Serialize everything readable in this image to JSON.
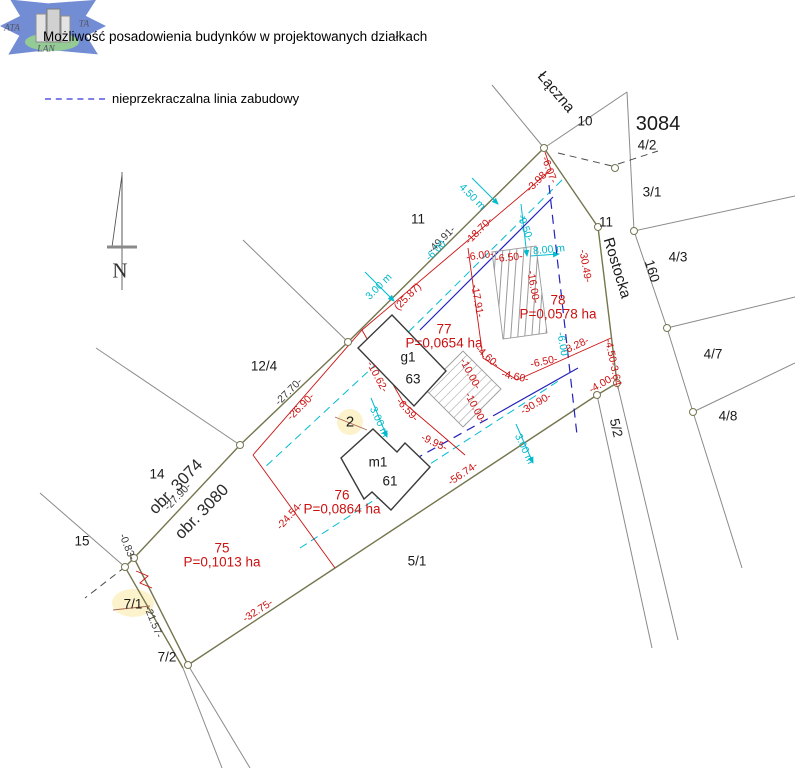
{
  "title": "Możliwość posadowienia budynków w projektowanych działkach",
  "legend": {
    "label": "nieprzekraczalna linia zabudowy",
    "line_color": "#8080e8"
  },
  "logo": {
    "texts": [
      "ATA",
      "TA",
      "LAN"
    ]
  },
  "colors": {
    "boundary_olive": "#75754e",
    "neighbor_gray": "#8a8a8a",
    "design_red": "#cc1111",
    "offset_cyan": "#00bcd0",
    "building_line_navy": "#2323bb",
    "highlight_yellow": "#fcf3cc"
  },
  "map_labels": [
    {
      "t": "Łączna",
      "x": 556,
      "y": 92,
      "r": 50,
      "k": "street"
    },
    {
      "t": "Rostocka",
      "x": 617,
      "y": 268,
      "r": 73,
      "k": "street"
    },
    {
      "t": "10",
      "x": 585,
      "y": 121,
      "r": 0,
      "k": "parcel"
    },
    {
      "t": "3084",
      "x": 658,
      "y": 124,
      "r": 0,
      "k": "parcel",
      "fs": 20
    },
    {
      "t": "4/2",
      "x": 647,
      "y": 145,
      "r": 0,
      "k": "parcel"
    },
    {
      "t": "3/1",
      "x": 652,
      "y": 192,
      "r": 0,
      "k": "parcel"
    },
    {
      "t": "11",
      "x": 606,
      "y": 222,
      "r": 0,
      "k": "parcel"
    },
    {
      "t": "160",
      "x": 652,
      "y": 271,
      "r": 73,
      "k": "parcel"
    },
    {
      "t": "4/3",
      "x": 678,
      "y": 257,
      "r": 0,
      "k": "parcel"
    },
    {
      "t": "4/7",
      "x": 713,
      "y": 354,
      "r": 0,
      "k": "parcel"
    },
    {
      "t": "4/8",
      "x": 728,
      "y": 416,
      "r": 0,
      "k": "parcel"
    },
    {
      "t": "5/2",
      "x": 616,
      "y": 428,
      "r": 77,
      "k": "parcel"
    },
    {
      "t": "5/1",
      "x": 417,
      "y": 561,
      "r": 0,
      "k": "parcel"
    },
    {
      "t": "11",
      "x": 418,
      "y": 219,
      "r": 0,
      "k": "parcel"
    },
    {
      "t": "12/4",
      "x": 264,
      "y": 366,
      "r": 0,
      "k": "parcel"
    },
    {
      "t": "14",
      "x": 157,
      "y": 474,
      "r": 0,
      "k": "parcel"
    },
    {
      "t": "15",
      "x": 82,
      "y": 541,
      "r": 0,
      "k": "parcel"
    },
    {
      "t": "7/1",
      "x": 133,
      "y": 604,
      "r": 0,
      "k": "parcel"
    },
    {
      "t": "7/2",
      "x": 167,
      "y": 657,
      "r": 0,
      "k": "parcel"
    },
    {
      "t": "2",
      "x": 350,
      "y": 422,
      "r": 0,
      "k": "parcel",
      "fs": 15
    },
    {
      "t": "g1",
      "x": 408,
      "y": 357,
      "r": 0,
      "k": "parcel"
    },
    {
      "t": "63",
      "x": 413,
      "y": 379,
      "r": 0,
      "k": "parcel"
    },
    {
      "t": "m1",
      "x": 378,
      "y": 462,
      "r": 0,
      "k": "parcel"
    },
    {
      "t": "61",
      "x": 390,
      "y": 481,
      "r": 0,
      "k": "parcel"
    },
    {
      "t": "obr. 3074",
      "x": 176,
      "y": 487,
      "r": -46,
      "k": "obr"
    },
    {
      "t": "obr. 3080",
      "x": 202,
      "y": 512,
      "r": -46,
      "k": "obr"
    },
    {
      "t": "N",
      "x": 120,
      "y": 271,
      "r": 0,
      "k": "north"
    },
    {
      "t": "75",
      "x": 222,
      "y": 548,
      "r": 0,
      "k": "redarea"
    },
    {
      "t": "P=0,1013 ha",
      "x": 222,
      "y": 562,
      "r": 0,
      "k": "redarea"
    },
    {
      "t": "76",
      "x": 342,
      "y": 495,
      "r": 0,
      "k": "redarea"
    },
    {
      "t": "P=0,0864 ha",
      "x": 342,
      "y": 509,
      "r": 0,
      "k": "redarea"
    },
    {
      "t": "77",
      "x": 444,
      "y": 329,
      "r": 0,
      "k": "redarea"
    },
    {
      "t": "P=0,0654 ha",
      "x": 444,
      "y": 343,
      "r": 0,
      "k": "redarea"
    },
    {
      "t": "78",
      "x": 558,
      "y": 300,
      "r": 0,
      "k": "redarea"
    },
    {
      "t": "P=0,0578 ha",
      "x": 558,
      "y": 314,
      "r": 0,
      "k": "redarea"
    },
    {
      "t": "-6.07-",
      "x": 549,
      "y": 170,
      "r": 70,
      "k": "red"
    },
    {
      "t": "-3.98-",
      "x": 538,
      "y": 181,
      "r": -45,
      "k": "red"
    },
    {
      "t": "-18.70-",
      "x": 479,
      "y": 231,
      "r": -45,
      "k": "red"
    },
    {
      "t": "(25.87)",
      "x": 408,
      "y": 297,
      "r": -45,
      "k": "red"
    },
    {
      "t": "-26.90-",
      "x": 301,
      "y": 407,
      "r": -45,
      "k": "red"
    },
    {
      "t": "-24.54-",
      "x": 290,
      "y": 516,
      "r": -48,
      "k": "red"
    },
    {
      "t": "-32.75-",
      "x": 258,
      "y": 611,
      "r": -33,
      "k": "red"
    },
    {
      "t": "-56.74-",
      "x": 463,
      "y": 474,
      "r": -34,
      "k": "red"
    },
    {
      "t": "-30.90-",
      "x": 536,
      "y": 404,
      "r": -30,
      "k": "red"
    },
    {
      "t": "-17.91-",
      "x": 477,
      "y": 301,
      "r": 80,
      "k": "red"
    },
    {
      "t": "-10.62-",
      "x": 377,
      "y": 377,
      "r": 62,
      "k": "red"
    },
    {
      "t": "-6.59-",
      "x": 407,
      "y": 410,
      "r": 48,
      "k": "red"
    },
    {
      "t": "-9.95-",
      "x": 434,
      "y": 443,
      "r": 25,
      "k": "red"
    },
    {
      "t": "-10.00-",
      "x": 470,
      "y": 374,
      "r": 62,
      "k": "red"
    },
    {
      "t": "-10.00-",
      "x": 475,
      "y": 408,
      "r": 62,
      "k": "red"
    },
    {
      "t": "-4.60-",
      "x": 487,
      "y": 357,
      "r": 42,
      "k": "red"
    },
    {
      "t": "-4.60-",
      "x": 515,
      "y": 377,
      "r": 12,
      "k": "red"
    },
    {
      "t": "-6.50-",
      "x": 509,
      "y": 258,
      "r": -6,
      "k": "red"
    },
    {
      "t": "-16.00-",
      "x": 533,
      "y": 287,
      "r": 80,
      "k": "red"
    },
    {
      "t": "-6.50-",
      "x": 544,
      "y": 362,
      "r": -12,
      "k": "red"
    },
    {
      "t": "-6.00-",
      "x": 480,
      "y": 256,
      "r": -8,
      "k": "red"
    },
    {
      "t": "-8.28-",
      "x": 576,
      "y": 346,
      "r": -25,
      "k": "red"
    },
    {
      "t": "-30.49-",
      "x": 585,
      "y": 266,
      "r": 80,
      "k": "red"
    },
    {
      "t": "-4.50-3.64-",
      "x": 613,
      "y": 364,
      "r": 78,
      "k": "red"
    },
    {
      "t": "-4.00-",
      "x": 602,
      "y": 384,
      "r": -30,
      "k": "red"
    },
    {
      "t": "-49.91-",
      "x": 442,
      "y": 240,
      "r": -45,
      "k": "blackdim"
    },
    {
      "t": "-27.70-",
      "x": 289,
      "y": 392,
      "r": -45,
      "k": "blackdim"
    },
    {
      "t": "-27.90-",
      "x": 178,
      "y": 497,
      "r": -46,
      "k": "blackdim"
    },
    {
      "t": "-0.83-",
      "x": 127,
      "y": 547,
      "r": 68,
      "k": "blackdim"
    },
    {
      "t": "-21.57-",
      "x": 153,
      "y": 622,
      "r": 68,
      "k": "blackdim"
    },
    {
      "t": "4.50 m",
      "x": 472,
      "y": 197,
      "r": 45,
      "k": "cyan"
    },
    {
      "t": "-9.50-",
      "x": 525,
      "y": 228,
      "r": 70,
      "k": "cyan"
    },
    {
      "t": "8.00 m",
      "x": 549,
      "y": 250,
      "r": -6,
      "k": "cyan"
    },
    {
      "t": "3.00 m",
      "x": 379,
      "y": 287,
      "r": -45,
      "k": "cyan"
    },
    {
      "t": "3.00 m",
      "x": 379,
      "y": 422,
      "r": 65,
      "k": "cyan"
    },
    {
      "t": "3.00 m",
      "x": 524,
      "y": 449,
      "r": 65,
      "k": "cyan"
    },
    {
      "t": "-6.00",
      "x": 562,
      "y": 344,
      "r": 80,
      "k": "cyan"
    },
    {
      "t": "-6.00",
      "x": 436,
      "y": 251,
      "r": -45,
      "k": "cyan"
    },
    {
      "t": "ATA",
      "x": 12,
      "y": 29,
      "r": 0,
      "k": "logo"
    },
    {
      "t": "TA",
      "x": 84,
      "y": 25,
      "r": 0,
      "k": "logo"
    },
    {
      "t": "LAN",
      "x": 46,
      "y": 50,
      "r": 0,
      "k": "logo"
    }
  ]
}
